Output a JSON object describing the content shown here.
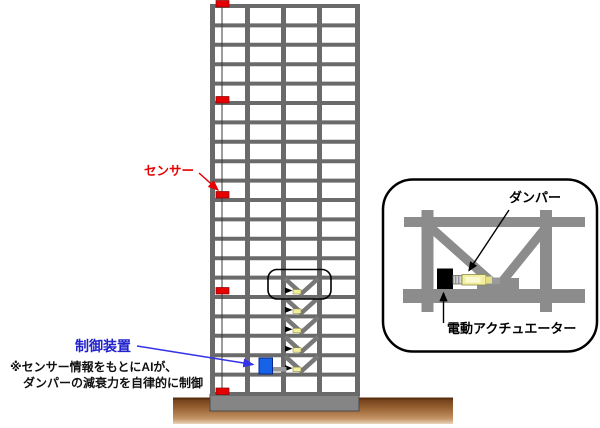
{
  "building": {
    "floors": 20,
    "bays": 4,
    "sensors": {
      "label": "センサー",
      "count": 5,
      "color": "#e60000"
    },
    "controller": {
      "label": "制御装置",
      "color": "#1763e8",
      "label_color": "#2222cc"
    },
    "note": {
      "line1": "※センサー情報をもとにAIが、",
      "line2": "ダンパーの減衰力を自律的に制御"
    },
    "dampers": {
      "count": 5,
      "color": "#f3ef9e"
    }
  },
  "inset": {
    "damper_label": "ダンパー",
    "actuator_label": "電動アクチュエーター"
  },
  "colors": {
    "frame_gray": "#6a6a6a",
    "inset_gray": "#8c8c8c",
    "ground_brown": "#8a5526",
    "arrow_blue": "#3333e8",
    "arrow_red": "#e60000",
    "damper_yellow": "#f3ef9e"
  }
}
